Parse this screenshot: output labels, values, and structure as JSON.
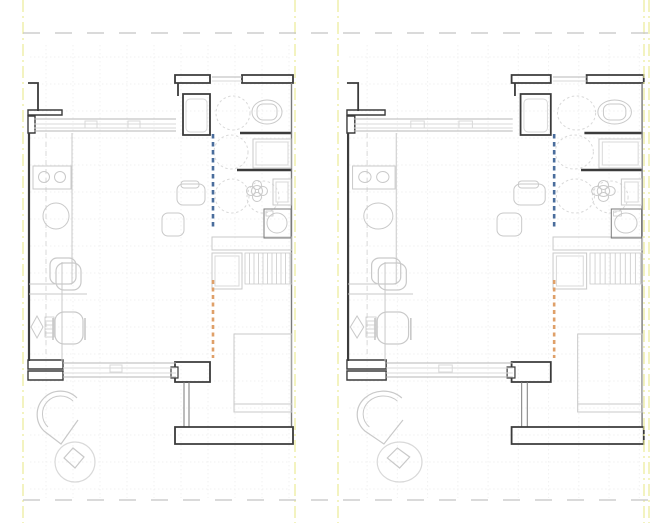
{
  "drawing": {
    "kind": "floor-plan",
    "description": "Two side-by-side studio apartment floor plan variants with accessibility turning circles and section markers",
    "width": 665,
    "height": 523
  },
  "colors": {
    "wall": "#3b3b3b",
    "wallMed": "#7a7a7a",
    "gray": "#b7b7b7",
    "light": "#d9d9d9",
    "furn": "#c9c9c9",
    "blue": "#4a6d9c",
    "orange": "#dfa069",
    "yellow": "#ebeb96",
    "gridc": "#f1f1f1",
    "dashg": "#c4c4c4",
    "white": "#ffffff"
  },
  "frame": {
    "boundary_vlines": [
      {
        "n": "boundary-line-left",
        "x": 23
      },
      {
        "n": "boundary-line-mid-left",
        "x": 295
      },
      {
        "n": "boundary-line-mid-right",
        "x": 338
      },
      {
        "n": "boundary-line-right-a",
        "x": 644
      },
      {
        "n": "boundary-line-right-b",
        "x": 649
      }
    ],
    "reference_hlines": [
      {
        "n": "reference-line-top",
        "y": 33,
        "x1": 23,
        "x2": 649
      },
      {
        "n": "reference-line-bottom",
        "y": 500,
        "x1": 23,
        "x2": 649
      }
    ]
  },
  "grid": {
    "x0": 30,
    "x1": 290,
    "y0": 45,
    "y1": 498,
    "step": 27
  },
  "panels": [
    {
      "name": "floor-plan-left",
      "tx": 0,
      "sx": 1
    },
    {
      "name": "floor-plan-right",
      "tx": 315.6,
      "sx": 1.12
    }
  ],
  "plan": {
    "primitives": [
      {
        "n": "wall-pilaster-top",
        "t": "path",
        "d": "M38,111 L38,83 L28,83",
        "s": "wall",
        "w": 1.8
      },
      {
        "n": "wall-pilaster-base",
        "t": "rect",
        "x": 28,
        "y": 110,
        "w2": 34,
        "h": 5,
        "s": "wall",
        "w": 1.4
      },
      {
        "n": "window-jamb-topleft",
        "t": "rect",
        "x": 28,
        "y": 116,
        "w2": 7,
        "h": 17,
        "s": "wall",
        "w": 1.4
      },
      {
        "n": "wall-left",
        "t": "line",
        "x1": 29,
        "y1": 133,
        "x2": 29,
        "y2": 361,
        "s": "wall",
        "w": 2.2
      },
      {
        "n": "window-jamb-botleft-a",
        "t": "rect",
        "x": 28,
        "y": 360,
        "w2": 35,
        "h": 9,
        "s": "wall",
        "w": 1.4
      },
      {
        "n": "window-jamb-botleft-b",
        "t": "rect",
        "x": 28,
        "y": 371,
        "w2": 35,
        "h": 9,
        "s": "wall",
        "w": 1.4
      },
      {
        "n": "wall-top-a",
        "t": "rect",
        "x": 175,
        "y": 75,
        "w2": 35,
        "h": 8,
        "s": "wall",
        "w": 1.8
      },
      {
        "n": "wall-top-b",
        "t": "rect",
        "x": 242,
        "y": 75,
        "w2": 51,
        "h": 8,
        "s": "wall",
        "w": 1.8
      },
      {
        "n": "wall-shaft-left",
        "t": "line",
        "x1": 178,
        "y1": 83,
        "x2": 178,
        "y2": 96,
        "s": "wall",
        "w": 1.8
      },
      {
        "n": "wall-shaft",
        "t": "rect",
        "x": 183,
        "y": 94,
        "w2": 27,
        "h": 41,
        "s": "wall",
        "w": 1.8
      },
      {
        "n": "shaft-appliance",
        "t": "rect",
        "x": 186,
        "y": 99,
        "w2": 21,
        "h": 33,
        "rx": 4,
        "s": "light",
        "w": 1
      },
      {
        "n": "wall-bath-1",
        "t": "line",
        "x1": 240,
        "y1": 133,
        "x2": 292,
        "y2": 133,
        "s": "wall",
        "w": 2.4
      },
      {
        "n": "wall-bath-2",
        "t": "line",
        "x1": 237,
        "y1": 170,
        "x2": 292,
        "y2": 170,
        "s": "wall",
        "w": 2.4
      },
      {
        "n": "wall-right",
        "t": "line",
        "x1": 291.5,
        "y1": 83,
        "x2": 291.5,
        "y2": 427,
        "s": "wallMed",
        "w": 1.4
      },
      {
        "n": "wall-door-bottom",
        "t": "rect",
        "x": 175,
        "y": 362,
        "w2": 35,
        "h": 20,
        "s": "wall",
        "w": 1.8
      },
      {
        "n": "door-notch",
        "t": "rect",
        "x": 171,
        "y": 367,
        "w2": 7,
        "h": 11,
        "s": "wall",
        "w": 1.2,
        "f": "#ffffff"
      },
      {
        "n": "partition-a",
        "t": "line",
        "x1": 184,
        "y1": 382,
        "x2": 184,
        "y2": 427,
        "s": "wallMed",
        "w": 1
      },
      {
        "n": "partition-b",
        "t": "line",
        "x1": 189,
        "y1": 382,
        "x2": 189,
        "y2": 427,
        "s": "wallMed",
        "w": 1
      },
      {
        "n": "wall-bottom-band",
        "t": "rect",
        "x": 175,
        "y": 427,
        "w2": 118,
        "h": 17,
        "s": "wall",
        "w": 1.8
      },
      {
        "n": "window-top-outer1",
        "t": "line",
        "x1": 34,
        "y1": 119,
        "x2": 176,
        "y2": 119,
        "s": "gray",
        "w": 1
      },
      {
        "n": "window-top-inner1",
        "t": "line",
        "x1": 34,
        "y1": 124,
        "x2": 176,
        "y2": 124,
        "s": "light",
        "w": 1
      },
      {
        "n": "window-top-inner2",
        "t": "line",
        "x1": 34,
        "y1": 128,
        "x2": 176,
        "y2": 128,
        "s": "light",
        "w": 1
      },
      {
        "n": "window-top-outer2",
        "t": "line",
        "x1": 34,
        "y1": 131,
        "x2": 176,
        "y2": 131,
        "s": "gray",
        "w": 1
      },
      {
        "n": "window-top-handle1",
        "t": "rect",
        "x": 85,
        "y": 121,
        "w2": 12,
        "h": 7,
        "s": "light",
        "w": 1
      },
      {
        "n": "window-top-handle2",
        "t": "rect",
        "x": 128,
        "y": 121,
        "w2": 12,
        "h": 7,
        "s": "light",
        "w": 1
      },
      {
        "n": "window-bath-1",
        "t": "line",
        "x1": 212,
        "y1": 77,
        "x2": 242,
        "y2": 77,
        "s": "gray",
        "w": 1
      },
      {
        "n": "window-bath-2",
        "t": "line",
        "x1": 212,
        "y1": 81,
        "x2": 242,
        "y2": 81,
        "s": "light",
        "w": 1
      },
      {
        "n": "window-bot-outer1",
        "t": "line",
        "x1": 63,
        "y1": 363,
        "x2": 176,
        "y2": 363,
        "s": "gray",
        "w": 1
      },
      {
        "n": "window-bot-inner1",
        "t": "line",
        "x1": 63,
        "y1": 368,
        "x2": 176,
        "y2": 368,
        "s": "light",
        "w": 1
      },
      {
        "n": "window-bot-inner2",
        "t": "line",
        "x1": 63,
        "y1": 373,
        "x2": 176,
        "y2": 373,
        "s": "light",
        "w": 1
      },
      {
        "n": "window-bot-outer2",
        "t": "line",
        "x1": 63,
        "y1": 377,
        "x2": 176,
        "y2": 377,
        "s": "gray",
        "w": 1
      },
      {
        "n": "window-bot-handle",
        "t": "rect",
        "x": 110,
        "y": 365,
        "w2": 12,
        "h": 7,
        "s": "light",
        "w": 1
      },
      {
        "n": "kitchen-centerline",
        "t": "line",
        "x1": 46,
        "y1": 133,
        "x2": 46,
        "y2": 358,
        "s": "light",
        "w": 1,
        "d": "5,4"
      },
      {
        "n": "kitchen-counter-edge",
        "t": "line",
        "x1": 72,
        "y1": 133,
        "x2": 72,
        "y2": 284,
        "s": "furn",
        "w": 1
      },
      {
        "n": "kitchen-counter-end",
        "t": "line",
        "x1": 29,
        "y1": 284,
        "x2": 72,
        "y2": 284,
        "s": "furn",
        "w": 1
      },
      {
        "n": "cooktop",
        "t": "rect",
        "x": 33,
        "y": 166,
        "w2": 38,
        "h": 23,
        "s": "furn",
        "w": 1
      },
      {
        "n": "cooktop-burner-1",
        "t": "circle",
        "cx": 44,
        "cy": 177,
        "r": 5.5,
        "s": "furn",
        "w": 1
      },
      {
        "n": "cooktop-burner-2",
        "t": "circle",
        "cx": 60,
        "cy": 177,
        "r": 5.5,
        "s": "furn",
        "w": 1
      },
      {
        "n": "kitchen-sink",
        "t": "circle",
        "cx": 56,
        "cy": 216,
        "r": 13,
        "s": "furn",
        "w": 1
      },
      {
        "n": "dining-chair",
        "t": "rect",
        "x": 50,
        "y": 258,
        "w2": 26,
        "h": 26,
        "rx": 7,
        "s": "furn",
        "w": 1.2
      },
      {
        "n": "desk-edge",
        "t": "line",
        "x1": 29,
        "y1": 294,
        "x2": 87,
        "y2": 294,
        "s": "furn",
        "w": 1
      },
      {
        "n": "desk-side",
        "t": "line",
        "x1": 62,
        "y1": 262,
        "x2": 62,
        "y2": 362,
        "s": "furn",
        "w": 1
      },
      {
        "n": "desk-chair-top",
        "t": "rect",
        "x": 56,
        "y": 263,
        "w2": 25,
        "h": 27,
        "rx": 8,
        "s": "furn",
        "w": 1.2
      },
      {
        "n": "desk-lamp",
        "t": "poly",
        "pts": "31,327 37,316 43,327 37,338",
        "s": "furn",
        "w": 1
      },
      {
        "n": "desk-tray",
        "t": "hatchh",
        "x": 45,
        "y": 317,
        "w2": 9,
        "h": 20,
        "step": 4,
        "s": "furn",
        "w": 0.8
      },
      {
        "n": "office-chair",
        "t": "rect",
        "x": 55,
        "y": 312,
        "w2": 28,
        "h": 32,
        "rx": 9,
        "s": "furn",
        "w": 1.2
      },
      {
        "n": "office-chair-arm-l",
        "t": "line",
        "x1": 53,
        "y1": 318,
        "x2": 53,
        "y2": 340,
        "s": "furn",
        "w": 1.6
      },
      {
        "n": "office-chair-arm-r",
        "t": "line",
        "x1": 85,
        "y1": 318,
        "x2": 85,
        "y2": 340,
        "s": "furn",
        "w": 1.6
      },
      {
        "n": "lounge-chair-outer",
        "t": "path",
        "d": "M77,398 A22,22 0 1 0 44,431 L61,444 L78,420",
        "s": "furn",
        "w": 1.2
      },
      {
        "n": "lounge-chair-inner",
        "t": "path",
        "d": "M73,401 A17,17 0 1 0 48,427",
        "s": "furn",
        "w": 1
      },
      {
        "n": "side-table",
        "t": "circle",
        "cx": 75,
        "cy": 462,
        "r": 20,
        "s": "light",
        "w": 1.2
      },
      {
        "n": "side-table-object",
        "t": "poly",
        "pts": "64,458 73,448 84,457 75,468",
        "s": "furn",
        "w": 1.2
      },
      {
        "n": "side-table-2",
        "t": "rect",
        "x": 177,
        "y": 184,
        "w2": 28,
        "h": 21,
        "rx": 6,
        "s": "furn",
        "w": 1
      },
      {
        "n": "side-table-2-top",
        "t": "rect",
        "x": 181,
        "y": 181,
        "w2": 18,
        "h": 7,
        "rx": 3,
        "s": "furn",
        "w": 1
      },
      {
        "n": "stool",
        "t": "rect",
        "x": 162,
        "y": 213,
        "w2": 22,
        "h": 23,
        "rx": 6,
        "s": "furn",
        "w": 1
      },
      {
        "n": "counter-island",
        "t": "rect",
        "x": 212,
        "y": 237,
        "w2": 80,
        "h": 13,
        "s": "furn",
        "w": 1
      },
      {
        "n": "cabinet",
        "t": "rect",
        "x": 212,
        "y": 253,
        "w2": 30,
        "h": 36,
        "s": "furn",
        "w": 1
      },
      {
        "n": "cabinet-inner",
        "t": "rect",
        "x": 215,
        "y": 256,
        "w2": 24,
        "h": 30,
        "s": "light",
        "w": 1
      },
      {
        "n": "drying-rack",
        "t": "hatchv",
        "x": 245,
        "y": 253,
        "w2": 47,
        "h": 31,
        "step": 4.5,
        "s": "furn",
        "w": 0.8
      },
      {
        "n": "curtain-left",
        "t": "path",
        "d": "3,3",
        "s": "light",
        "w": 1
      },
      {
        "n": "curtain-right",
        "t": "path",
        "d": "3,3",
        "s": "light",
        "w": 1
      },
      {
        "n": "bed",
        "t": "rect",
        "x": 234,
        "y": 334,
        "w2": 58,
        "h": 78,
        "s": "furn",
        "w": 1
      },
      {
        "n": "bed-foot-line",
        "t": "line",
        "x1": 234,
        "y1": 404,
        "x2": 292,
        "y2": 404,
        "s": "furn",
        "w": 1
      },
      {
        "n": "toilet-bowl",
        "t": "ellipse",
        "cx": 267,
        "cy": 112,
        "rx": 15,
        "ry": 12,
        "s": "furn",
        "w": 1
      },
      {
        "n": "toilet-seat",
        "t": "rect",
        "x": 257,
        "y": 104,
        "w2": 20,
        "h": 16,
        "rx": 6,
        "s": "furn",
        "w": 1
      },
      {
        "n": "turning-circle-1",
        "t": "circle",
        "cx": 233,
        "cy": 113,
        "r": 17,
        "s": "light",
        "w": 1,
        "d": "2.5,2.5"
      },
      {
        "n": "shower-tray",
        "t": "rect",
        "x": 253,
        "y": 139,
        "w2": 38,
        "h": 29,
        "s": "furn",
        "w": 1
      },
      {
        "n": "shower-tray-inner",
        "t": "rect",
        "x": 256,
        "y": 142,
        "w2": 32,
        "h": 23,
        "s": "light",
        "w": 1
      },
      {
        "n": "turning-circle-2",
        "t": "circle",
        "cx": 231,
        "cy": 152,
        "r": 17,
        "s": "light",
        "w": 1,
        "d": "2.5,2.5"
      },
      {
        "n": "turning-circle-3",
        "t": "circle",
        "cx": 232,
        "cy": 196,
        "r": 17,
        "s": "light",
        "w": 1,
        "d": "2.5,2.5"
      },
      {
        "n": "turning-circle-4",
        "t": "circle",
        "cx": 263,
        "cy": 197,
        "r": 16,
        "s": "light",
        "w": 1,
        "d": "2.5,2.5"
      },
      {
        "n": "basin-tap-petal-1",
        "t": "circle",
        "cx": 257,
        "cy": 185,
        "r": 4.5,
        "s": "furn",
        "w": 1
      },
      {
        "n": "basin-tap-petal-2",
        "t": "circle",
        "cx": 251,
        "cy": 191,
        "r": 4.5,
        "s": "furn",
        "w": 1
      },
      {
        "n": "basin-tap-petal-3",
        "t": "circle",
        "cx": 257,
        "cy": 197,
        "r": 4.5,
        "s": "furn",
        "w": 1
      },
      {
        "n": "basin-tap-petal-4",
        "t": "circle",
        "cx": 263,
        "cy": 191,
        "r": 4.5,
        "s": "furn",
        "w": 1
      },
      {
        "n": "basin-tap-center",
        "t": "circle",
        "cx": 257,
        "cy": 191,
        "r": 5.5,
        "s": "furn",
        "w": 1
      },
      {
        "n": "vanity",
        "t": "rect",
        "x": 273,
        "y": 179,
        "w2": 18,
        "h": 26,
        "s": "furn",
        "w": 1
      },
      {
        "n": "vanity-inner",
        "t": "rect",
        "x": 276,
        "y": 182,
        "w2": 12,
        "h": 20,
        "s": "light",
        "w": 1
      },
      {
        "n": "washing-machine",
        "t": "rect",
        "x": 264,
        "y": 209,
        "w2": 27,
        "h": 29,
        "s": "wallMed",
        "w": 1
      },
      {
        "n": "washing-machine-drum",
        "t": "circle",
        "cx": 277,
        "cy": 223,
        "r": 10,
        "s": "furn",
        "w": 1
      },
      {
        "n": "washing-machine-panel",
        "t": "rect",
        "x": 266,
        "y": 211,
        "w2": 7,
        "h": 5,
        "s": "furn",
        "w": 0.8
      },
      {
        "n": "section-marker-blue",
        "t": "line",
        "x1": 213,
        "y1": 134,
        "x2": 213,
        "y2": 230,
        "s": "blue",
        "w": 2.6,
        "d": "4.5,3.5"
      },
      {
        "n": "section-marker-orange",
        "t": "line",
        "x1": 213,
        "y1": 280,
        "x2": 213,
        "y2": 358,
        "s": "orange",
        "w": 2.6,
        "d": "4,3.5"
      }
    ]
  }
}
